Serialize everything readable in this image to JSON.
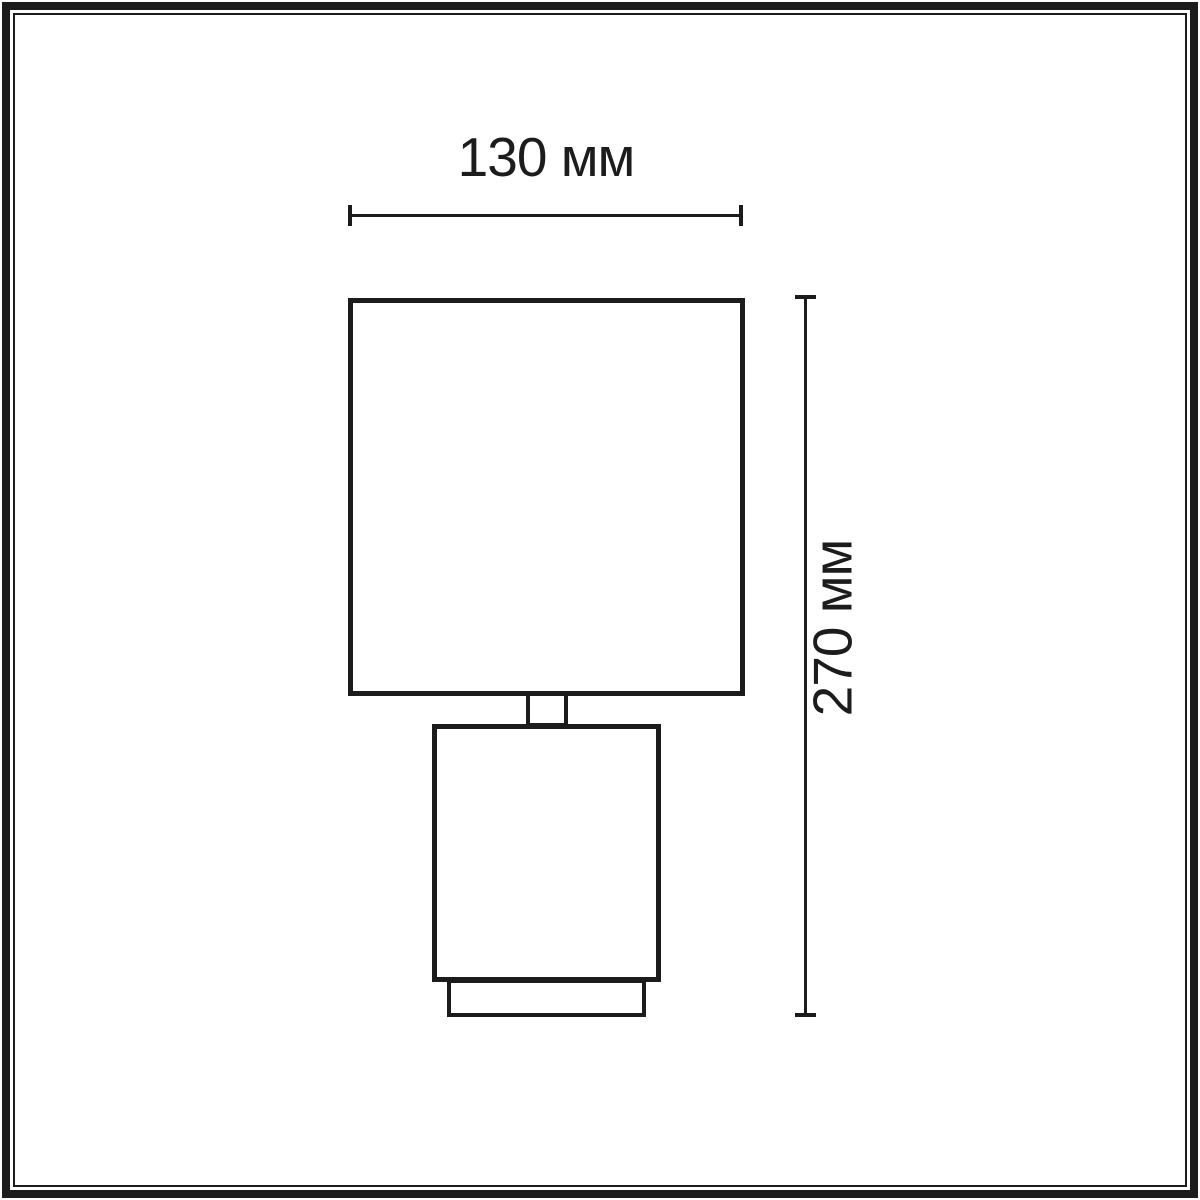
{
  "page": {
    "background": "#ffffff",
    "line_color": "#1c1c1c"
  },
  "dimensions": {
    "width": {
      "label": "130 мм",
      "value": 130,
      "unit": "мм"
    },
    "height": {
      "label": "270 мм",
      "value": 270,
      "unit": "мм"
    }
  }
}
